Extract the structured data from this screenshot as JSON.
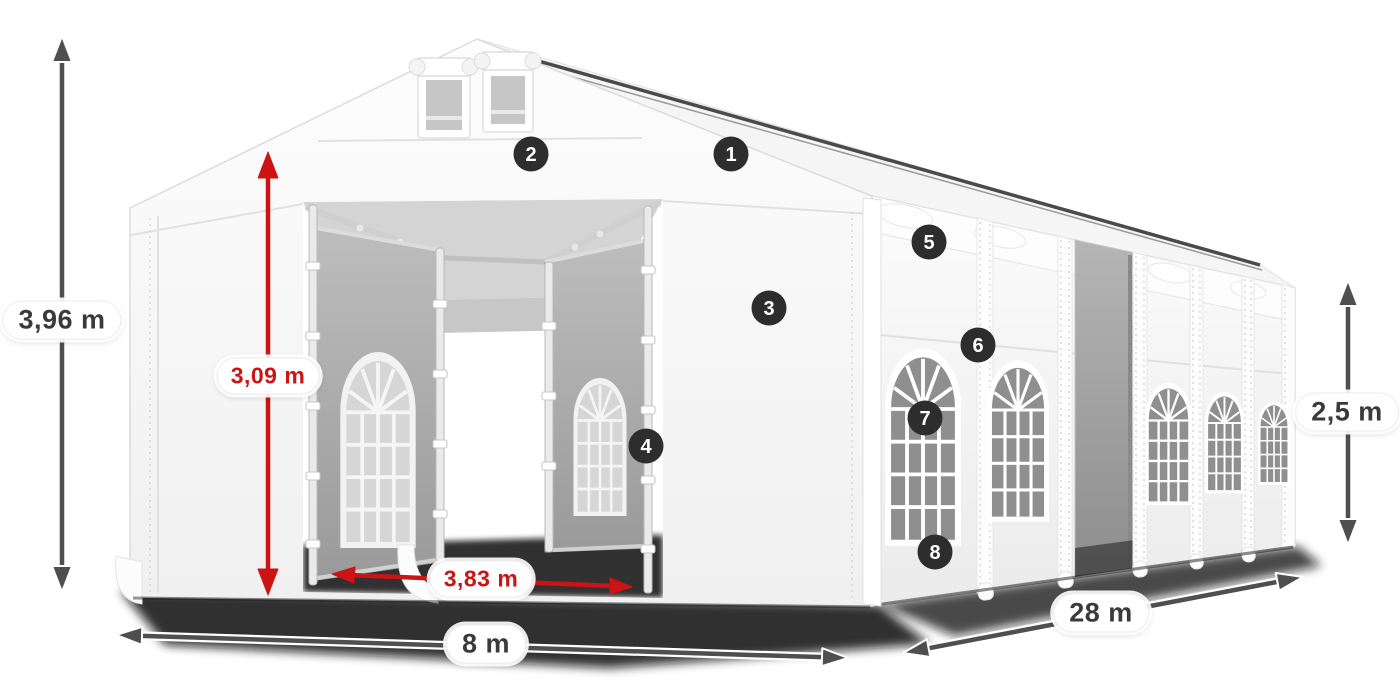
{
  "meta": {
    "description": "Isometric product dimension diagram of a white marquee party tent, 8 m wide x 28 m long, with two front entrances, side windows, numbered feature callouts and dimension arrows",
    "background_color": "#ffffff"
  },
  "palette": {
    "accent_red": "#cc1414",
    "dimension_gray": "#4f4f4f",
    "marker_bg": "#2d2d2d",
    "marker_text": "#ffffff",
    "tent_white": "#fafafa",
    "tent_outline": "#d9d9d9",
    "interior_gray": "#b0b0b0",
    "glass_gray": "#8f8f8f",
    "shadow": "#101010",
    "label_bg": "#ffffff",
    "label_text": "#3a3a3a"
  },
  "dimension_labels": {
    "total_height": {
      "text": "3,96 m",
      "color_role": "gray",
      "orientation": "vertical",
      "position": "far-left"
    },
    "entrance_height": {
      "text": "3,09 m",
      "color_role": "red",
      "orientation": "vertical",
      "position": "front-entrance"
    },
    "entrance_width": {
      "text": "3,83 m",
      "color_role": "red",
      "orientation": "horizontal",
      "position": "front-entrance-base"
    },
    "width": {
      "text": "8 m",
      "color_role": "gray",
      "orientation": "horizontal",
      "position": "bottom-front"
    },
    "length": {
      "text": "28 m",
      "color_role": "gray",
      "orientation": "diagonal",
      "position": "bottom-right"
    },
    "side_height": {
      "text": "2,5 m",
      "color_role": "gray",
      "orientation": "vertical",
      "position": "far-right"
    }
  },
  "markers": [
    {
      "number": "1"
    },
    {
      "number": "2"
    },
    {
      "number": "3"
    },
    {
      "number": "4"
    },
    {
      "number": "5"
    },
    {
      "number": "6"
    },
    {
      "number": "7"
    },
    {
      "number": "8"
    }
  ]
}
